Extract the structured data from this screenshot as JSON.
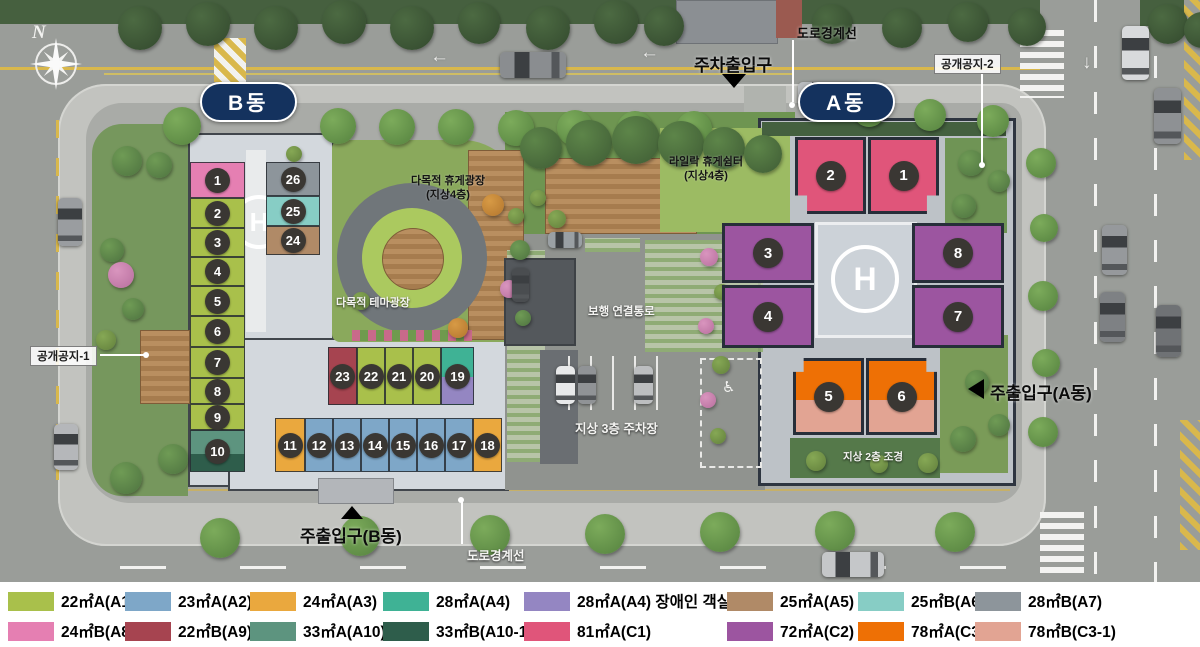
{
  "buildings": {
    "b_label": "B동",
    "a_label": "A동"
  },
  "labels": {
    "north": "N",
    "road_boundary_top": "도로경계선",
    "parking_gate": "주차출입구",
    "open_space_2": "공개공지-2",
    "open_space_1": "공개공지-1",
    "main_gate_a": "주출입구(A동)",
    "main_gate_b": "주출입구(B동)",
    "road_boundary_bottom": "도로경계선",
    "plaza_name": "다목적 휴게광장",
    "plaza_floor": "(지상4층)",
    "lilac_name": "라일락 휴게쉼터",
    "lilac_floor": "(지상4층)",
    "theme_plaza": "다목적 테마광장",
    "walk_link": "보행 연결통로",
    "parking_3f": "지상 3층 주차장",
    "landscape_2f": "지상 2층 조경",
    "helipad": "H"
  },
  "icons": {
    "wheelchair": "♿",
    "arrow_down": "↓",
    "arrow_left": "←"
  },
  "legend": {
    "items": [
      {
        "key": "A1",
        "label": "22㎡A(A1)",
        "color": "#a9c04b"
      },
      {
        "key": "A2",
        "label": "23㎡A(A2)",
        "color": "#7ea7c8"
      },
      {
        "key": "A3",
        "label": "24㎡A(A3)",
        "color": "#eaa83e"
      },
      {
        "key": "A4",
        "label": "28㎡A(A4)",
        "color": "#3fb295"
      },
      {
        "key": "A4D",
        "label": "28㎡A(A4) 장애인 객실",
        "color": "#9486c2"
      },
      {
        "key": "A5",
        "label": "25㎡A(A5)",
        "color": "#b08a67"
      },
      {
        "key": "A6",
        "label": "25㎡B(A6)",
        "color": "#87cdc5"
      },
      {
        "key": "A7",
        "label": "28㎡B(A7)",
        "color": "#8d959b"
      },
      {
        "key": "A8",
        "label": "24㎡B(A8)",
        "color": "#e57fb2"
      },
      {
        "key": "A9",
        "label": "22㎡B(A9)",
        "color": "#a64450"
      },
      {
        "key": "A10",
        "label": "33㎡A(A10)",
        "color": "#5d947f"
      },
      {
        "key": "A10-1",
        "label": "33㎡B(A10-1)",
        "color": "#2e5d4b"
      },
      {
        "key": "C1",
        "label": "81㎡A(C1)",
        "color": "#e0557a"
      },
      {
        "key": "C2",
        "label": "72㎡A(C2)",
        "color": "#9c55a0"
      },
      {
        "key": "C3",
        "label": "78㎡A(C3)",
        "color": "#ee7005"
      },
      {
        "key": "C3-1",
        "label": "78㎡B(C3-1)",
        "color": "#e2a493"
      }
    ]
  },
  "units": [
    {
      "building": "B",
      "no": 1,
      "type": "A8"
    },
    {
      "building": "B",
      "no": 2,
      "type": "A1"
    },
    {
      "building": "B",
      "no": 3,
      "type": "A1"
    },
    {
      "building": "B",
      "no": 4,
      "type": "A1"
    },
    {
      "building": "B",
      "no": 5,
      "type": "A1"
    },
    {
      "building": "B",
      "no": 6,
      "type": "A1"
    },
    {
      "building": "B",
      "no": 7,
      "type": "A1"
    },
    {
      "building": "B",
      "no": 8,
      "type": "A1"
    },
    {
      "building": "B",
      "no": 9,
      "type": "A1"
    },
    {
      "building": "B",
      "no": 10,
      "type": "A10",
      "type2": "A10-1"
    },
    {
      "building": "B",
      "no": 11,
      "type": "A3"
    },
    {
      "building": "B",
      "no": 12,
      "type": "A2"
    },
    {
      "building": "B",
      "no": 13,
      "type": "A2"
    },
    {
      "building": "B",
      "no": 14,
      "type": "A2"
    },
    {
      "building": "B",
      "no": 15,
      "type": "A2"
    },
    {
      "building": "B",
      "no": 16,
      "type": "A2"
    },
    {
      "building": "B",
      "no": 17,
      "type": "A2"
    },
    {
      "building": "B",
      "no": 18,
      "type": "A3"
    },
    {
      "building": "B",
      "no": 19,
      "type": "A4",
      "type2": "A4D"
    },
    {
      "building": "B",
      "no": 20,
      "type": "A1"
    },
    {
      "building": "B",
      "no": 21,
      "type": "A1"
    },
    {
      "building": "B",
      "no": 22,
      "type": "A1"
    },
    {
      "building": "B",
      "no": 23,
      "type": "A9"
    },
    {
      "building": "B",
      "no": 24,
      "type": "A5"
    },
    {
      "building": "B",
      "no": 25,
      "type": "A6"
    },
    {
      "building": "B",
      "no": 26,
      "type": "A7"
    },
    {
      "building": "A",
      "no": 1,
      "type": "C1"
    },
    {
      "building": "A",
      "no": 2,
      "type": "C1"
    },
    {
      "building": "A",
      "no": 3,
      "type": "C2"
    },
    {
      "building": "A",
      "no": 4,
      "type": "C2"
    },
    {
      "building": "A",
      "no": 5,
      "type": "C3",
      "type2": "C3-1"
    },
    {
      "building": "A",
      "no": 6,
      "type": "C3",
      "type2": "C3-1"
    },
    {
      "building": "A",
      "no": 7,
      "type": "C2"
    },
    {
      "building": "A",
      "no": 8,
      "type": "C2"
    }
  ]
}
